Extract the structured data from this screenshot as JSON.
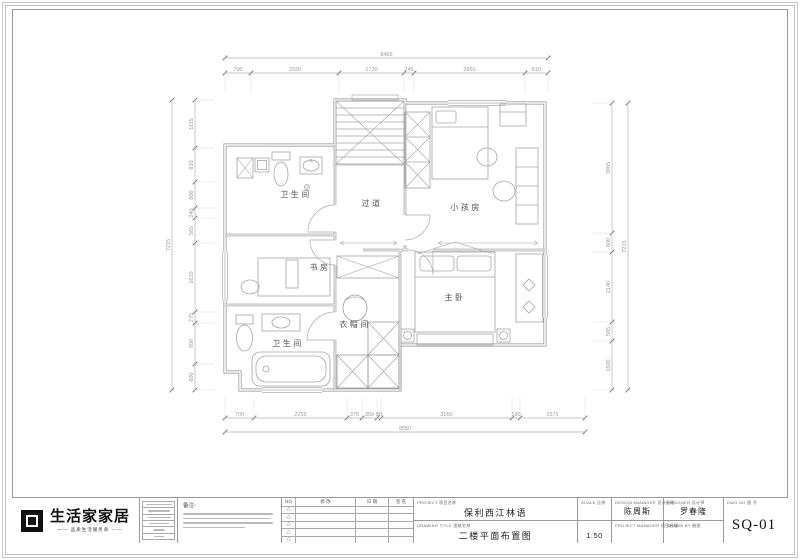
{
  "logo": {
    "name": "生活家家居",
    "tagline": "—— 品质生活服务商 ——"
  },
  "title_block": {
    "note_label": "备注:",
    "revision_headers": {
      "no": "NO",
      "content": "修 改",
      "date": "日 期",
      "sign": "签 名"
    },
    "project": {
      "label_en": "PROJECT",
      "label_cn": "项目名称",
      "value": "保利西江林语"
    },
    "drawing": {
      "label_en": "DRAWING TITLE",
      "label_cn": "图纸名称",
      "value": "二楼平面布置图"
    },
    "scale": {
      "label_en": "SCALE",
      "label_cn": "比例",
      "value": "1:50"
    },
    "design_manager": {
      "label_en": "DESIGN MANAGER",
      "label_cn": "设计经理",
      "value": "陈周斯"
    },
    "project_manager": {
      "label_en": "PROJECT MANAGER",
      "label_cn": "项目经理",
      "value": ""
    },
    "designer": {
      "label_en": "DESIGNER",
      "label_cn": "设计师",
      "value": "罗春隆"
    },
    "drawn_by": {
      "label_en": "DRAWN BY",
      "label_cn": "制图",
      "value": ""
    },
    "dwg_no": {
      "label_en": "DWG NO",
      "label_cn": "图 号",
      "value": "SQ-01"
    }
  },
  "plan": {
    "room_labels": [
      {
        "text": "卫生间",
        "x": 296,
        "y": 197
      },
      {
        "text": "过道",
        "x": 372,
        "y": 206
      },
      {
        "text": "小孩房",
        "x": 466,
        "y": 210
      },
      {
        "text": "书房",
        "x": 320,
        "y": 270
      },
      {
        "text": "衣帽间",
        "x": 355,
        "y": 327
      },
      {
        "text": "主卧",
        "x": 455,
        "y": 300
      },
      {
        "text": "卫生间",
        "x": 288,
        "y": 346
      }
    ],
    "dim_chains": [
      {
        "dir": "h",
        "pos": 73,
        "ticks": [
          225,
          251,
          339,
          404,
          414,
          525,
          548
        ],
        "labels": [
          "700",
          "2320",
          "1730",
          "245",
          "2950",
          "610"
        ],
        "ext": 1
      },
      {
        "dir": "h",
        "pos": 58,
        "ticks": [
          225,
          548
        ],
        "labels": [
          "8465"
        ],
        "ext": 0
      },
      {
        "dir": "h",
        "pos": 418,
        "ticks": [
          225,
          254,
          347,
          362,
          377,
          381,
          512,
          520,
          585
        ],
        "labels": [
          "700",
          "2255",
          "375",
          "350",
          "80",
          "3160",
          "190",
          "1571"
        ],
        "ext": -1
      },
      {
        "dir": "h",
        "pos": 432,
        "ticks": [
          225,
          585
        ],
        "labels": [
          "9550"
        ],
        "ext": 0
      },
      {
        "dir": "v",
        "pos": 195,
        "ticks": [
          100,
          148,
          182,
          208,
          218,
          243,
          312,
          323,
          364,
          390
        ],
        "labels": [
          "1115",
          "810",
          "600",
          "240",
          "565",
          "1610",
          "275",
          "950",
          "600"
        ],
        "ext": 1
      },
      {
        "dir": "v",
        "pos": 172,
        "ticks": [
          100,
          390
        ],
        "labels": [
          "7215"
        ],
        "ext": 0
      },
      {
        "dir": "v",
        "pos": 612,
        "ticks": [
          103,
          233,
          252,
          322,
          341,
          390
        ],
        "labels": [
          "3965",
          "600",
          "2140",
          "565",
          "1500"
        ],
        "ext": -1
      },
      {
        "dir": "v",
        "pos": 628,
        "ticks": [
          103,
          390
        ],
        "labels": [
          "7215"
        ],
        "ext": 0
      }
    ]
  },
  "colors": {
    "wall": "#8e8e8e",
    "furniture": "#a6a6a6",
    "dim_line": "#b3b3b3",
    "dim_text": "#9a9a9a",
    "label_text": "#555555",
    "logo_black": "#111111"
  }
}
